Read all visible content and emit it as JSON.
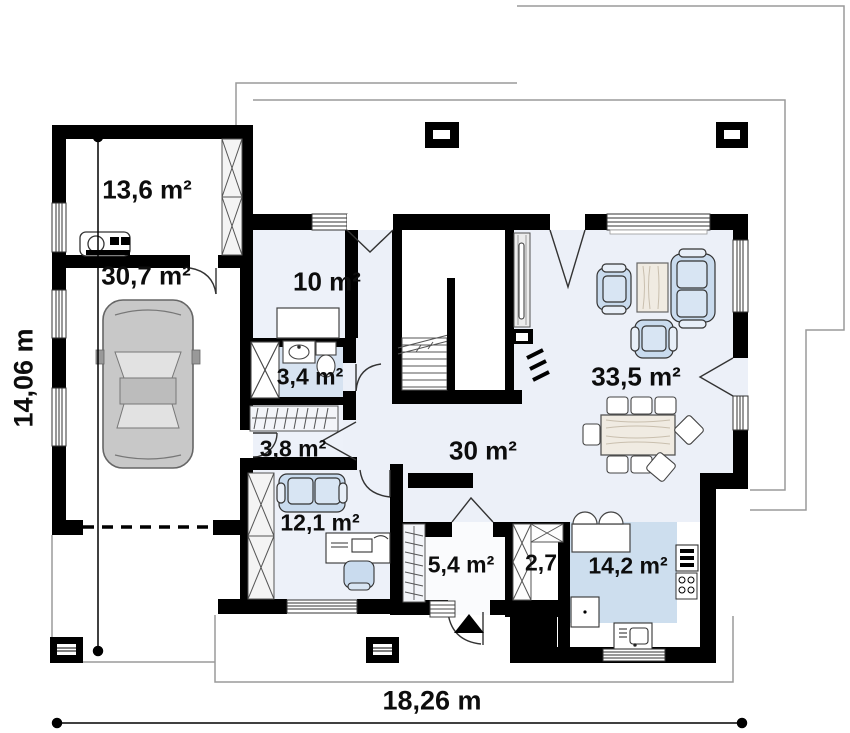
{
  "plan": {
    "title": "single-storey house floor plan",
    "rooms": [
      {
        "id": "utility",
        "label": "13,6 m²"
      },
      {
        "id": "garage",
        "label": "30,7 m²"
      },
      {
        "id": "bedroom",
        "label": "10 m²"
      },
      {
        "id": "bathroom",
        "label": "3,4 m²"
      },
      {
        "id": "hall-small",
        "label": "3,8 m²"
      },
      {
        "id": "office",
        "label": "12,1 m²"
      },
      {
        "id": "hall",
        "label": "30 m²"
      },
      {
        "id": "living",
        "label": "33,5 m²"
      },
      {
        "id": "vestibule",
        "label": "5,4 m²"
      },
      {
        "id": "closet",
        "label": "2,7"
      },
      {
        "id": "kitchen",
        "label": "14,2 m²"
      }
    ],
    "dimensions": {
      "width_label": "18,26 m",
      "height_label": "14,06 m"
    },
    "colors": {
      "wall": "#000000",
      "floor_tint": "#ecf0f8",
      "bathroom_tint": "#d7e3f1",
      "kitchen_tint": "#cddeee",
      "furniture_blue": "#c9dbee",
      "wood": "#f0ebe2",
      "roof_line": "#9a9a9a"
    }
  }
}
